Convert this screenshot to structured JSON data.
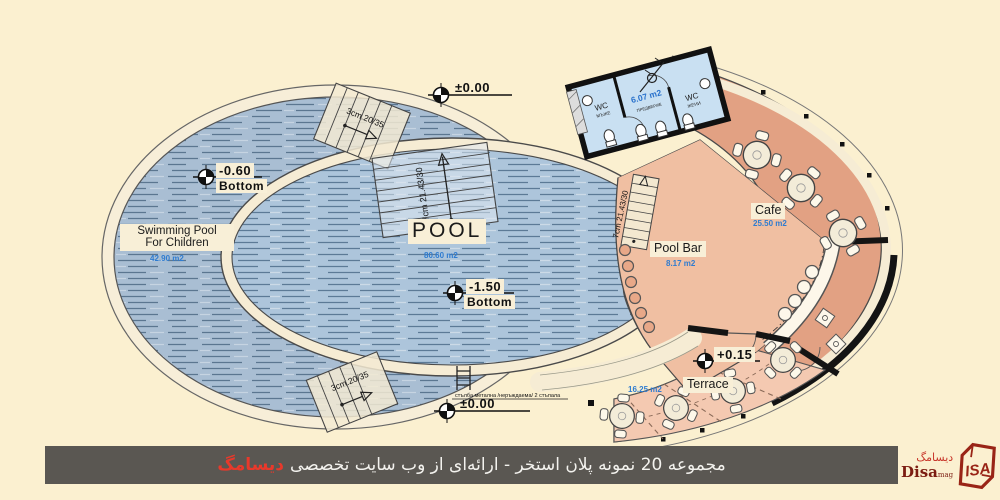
{
  "colors": {
    "background": "#fbf0d0",
    "water": "#adc5db",
    "cafe_floor": "#e2a183",
    "pool_bar_floor": "#f0bfa2",
    "terrace_floor": "#f4c9b1",
    "wc_floor": "#c9e0f2",
    "banner_bg": "#5a5752",
    "banner_highlight": "#e8392b",
    "area_text": "#2f7cd0",
    "logo_red": "#992416"
  },
  "plan": {
    "pool": {
      "name": "POOL",
      "area": "80.60 m2"
    },
    "children": {
      "name1": "Swimming Pool",
      "name2": "For Children",
      "area": "42.90 m2"
    },
    "cafe": {
      "name": "Cafe",
      "area": "25.50 m2"
    },
    "pool_bar": {
      "name": "Pool Bar",
      "area": "8.17 m2"
    },
    "terrace": {
      "name": "Terrace",
      "area": "16.25 m2"
    },
    "wc": {
      "men1": "WC",
      "men2": "МЪЖЕ",
      "women1": "WC",
      "women2": "ЖЕНИ",
      "area": "6.07 m2",
      "vestibule": "ПРЕДВЕРИЕ"
    },
    "levels": {
      "zero": "±0.00",
      "minus060": "-0.60",
      "minus150": "-1.50",
      "plus015": "+0.15",
      "bottom": "Bottom"
    },
    "stairs": {
      "s3": "3cm.20/35",
      "s7": "7cm 21.43/30"
    },
    "ladder_note": "стълба метална /неръждаема/ 2 стъпала"
  },
  "banner": {
    "text": "مجموعه 20 نمونه پلان استخر - ارائه‌ای از وب سایت تخصصی",
    "highlight": "دیسامگ"
  },
  "logo": {
    "fa": "دیسامگ",
    "en": "Disa",
    "suffix": "mag",
    "mark": "ISA"
  }
}
